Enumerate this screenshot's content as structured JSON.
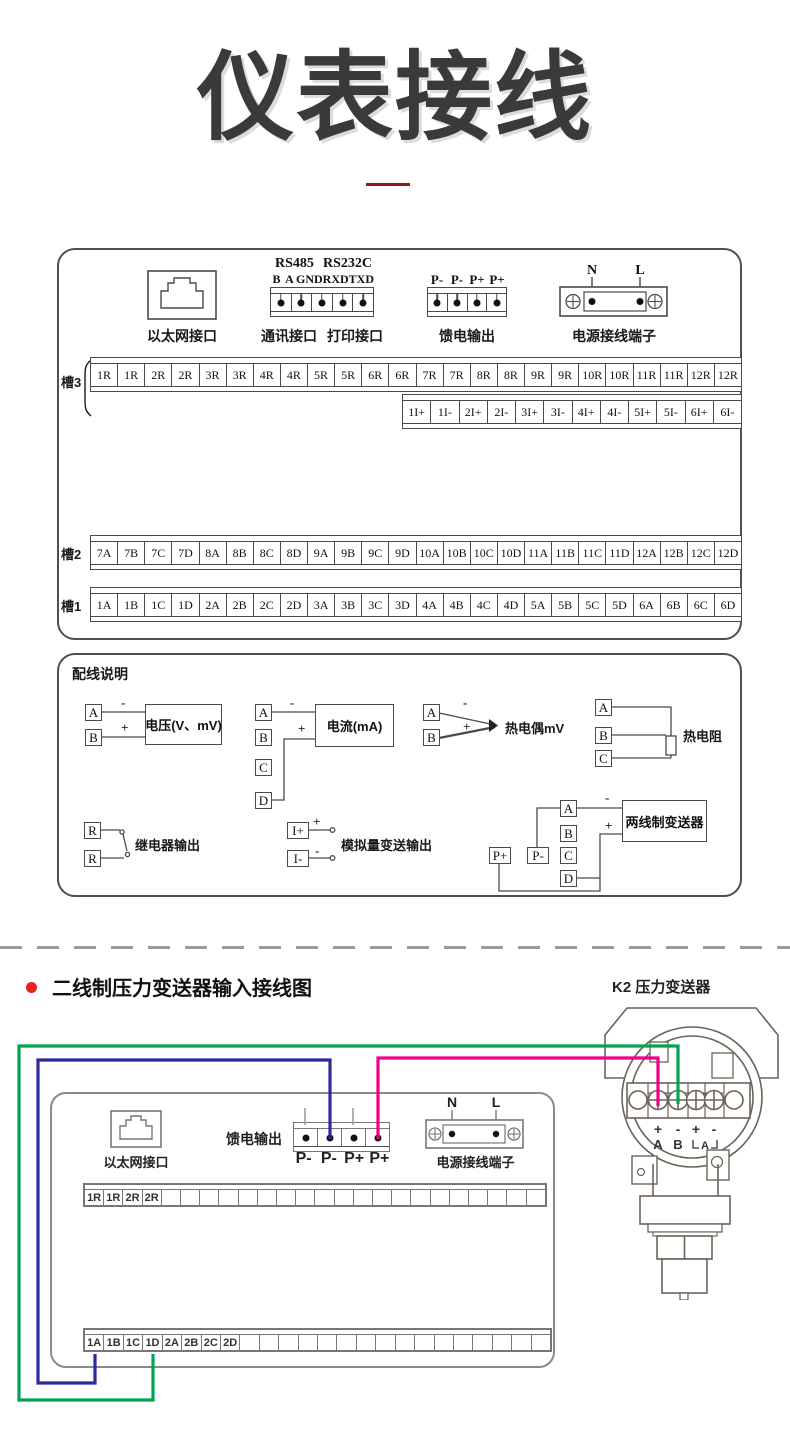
{
  "title": "仪表接线",
  "colors": {
    "accent_red": "#8e1b1b",
    "bullet_red": "#e62222",
    "wire_blue": "#2b2ba0",
    "wire_green": "#00a551",
    "wire_magenta": "#ec008c"
  },
  "panel1": {
    "ethernet_label": "以太网接口",
    "comm": {
      "rs485": "RS485",
      "rs232c": "RS232C",
      "pins": [
        "B",
        "A",
        "GND",
        "RXD",
        "TXD"
      ],
      "label_left": "通讯接口",
      "label_right": "打印接口"
    },
    "feed": {
      "pins": [
        "P-",
        "P-",
        "P+",
        "P+"
      ],
      "label": "馈电输出"
    },
    "power": {
      "n": "N",
      "l": "L",
      "label": "电源接线端子"
    },
    "slot3": {
      "label": "槽3",
      "row1": [
        "1R",
        "1R",
        "2R",
        "2R",
        "3R",
        "3R",
        "4R",
        "4R",
        "5R",
        "5R",
        "6R",
        "6R",
        "7R",
        "7R",
        "8R",
        "8R",
        "9R",
        "9R",
        "10R",
        "10R",
        "11R",
        "11R",
        "12R",
        "12R"
      ],
      "row2": [
        "1I+",
        "1I-",
        "2I+",
        "2I-",
        "3I+",
        "3I-",
        "4I+",
        "4I-",
        "5I+",
        "5I-",
        "6I+",
        "6I-"
      ]
    },
    "slot2": {
      "label": "槽2",
      "cells": [
        "7A",
        "7B",
        "7C",
        "7D",
        "8A",
        "8B",
        "8C",
        "8D",
        "9A",
        "9B",
        "9C",
        "9D",
        "10A",
        "10B",
        "10C",
        "10D",
        "11A",
        "11B",
        "11C",
        "11D",
        "12A",
        "12B",
        "12C",
        "12D"
      ]
    },
    "slot1": {
      "label": "槽1",
      "cells": [
        "1A",
        "1B",
        "1C",
        "1D",
        "2A",
        "2B",
        "2C",
        "2D",
        "3A",
        "3B",
        "3C",
        "3D",
        "4A",
        "4B",
        "4C",
        "4D",
        "5A",
        "5B",
        "5C",
        "5D",
        "6A",
        "6B",
        "6C",
        "6D"
      ]
    }
  },
  "panel2": {
    "header": "配线说明",
    "voltage": {
      "a": "A",
      "b": "B",
      "minus": "-",
      "plus": "+",
      "box": "电压(V、mV)"
    },
    "current": {
      "a": "A",
      "b": "B",
      "c": "C",
      "d": "D",
      "minus": "-",
      "plus": "+",
      "box": "电流(mA)"
    },
    "tc": {
      "a": "A",
      "b": "B",
      "minus": "-",
      "plus": "+",
      "label": "热电偶mV"
    },
    "rtd": {
      "a": "A",
      "b": "B",
      "c": "C",
      "label": "热电阻"
    },
    "relay": {
      "r1": "R",
      "r2": "R",
      "label": "继电器输出"
    },
    "analog": {
      "ip": "I+",
      "im": "I-",
      "plus": "+",
      "minus": "-",
      "label": "模拟量变送输出"
    },
    "twowire": {
      "pp": "P+",
      "pm": "P-",
      "a": "A",
      "b": "B",
      "c": "C",
      "d": "D",
      "minus": "-",
      "plus": "+",
      "box": "两线制变送器"
    }
  },
  "bottom": {
    "section_title": "二线制压力变送器输入接线图",
    "k2_label": "K2  压力变送器",
    "transmitter": {
      "signs": [
        "+",
        "-",
        "+",
        "-"
      ],
      "a": "A",
      "b": "B",
      "bracket_a": "A"
    },
    "recorder": {
      "ethernet_label": "以太网接口",
      "feed_label": "馈电输出",
      "feed_pins": [
        "P-",
        "P-",
        "P+",
        "P+"
      ],
      "power": {
        "n": "N",
        "l": "L",
        "label": "电源接线端子"
      },
      "row1": [
        "1R",
        "1R",
        "2R",
        "2R",
        "",
        "",
        "",
        "",
        "",
        "",
        "",
        "",
        "",
        "",
        "",
        "",
        "",
        "",
        "",
        "",
        "",
        "",
        "",
        ""
      ],
      "row2": [
        "1A",
        "1B",
        "1C",
        "1D",
        "2A",
        "2B",
        "2C",
        "2D",
        "",
        "",
        "",
        "",
        "",
        "",
        "",
        "",
        "",
        "",
        "",
        "",
        "",
        "",
        "",
        ""
      ]
    }
  }
}
